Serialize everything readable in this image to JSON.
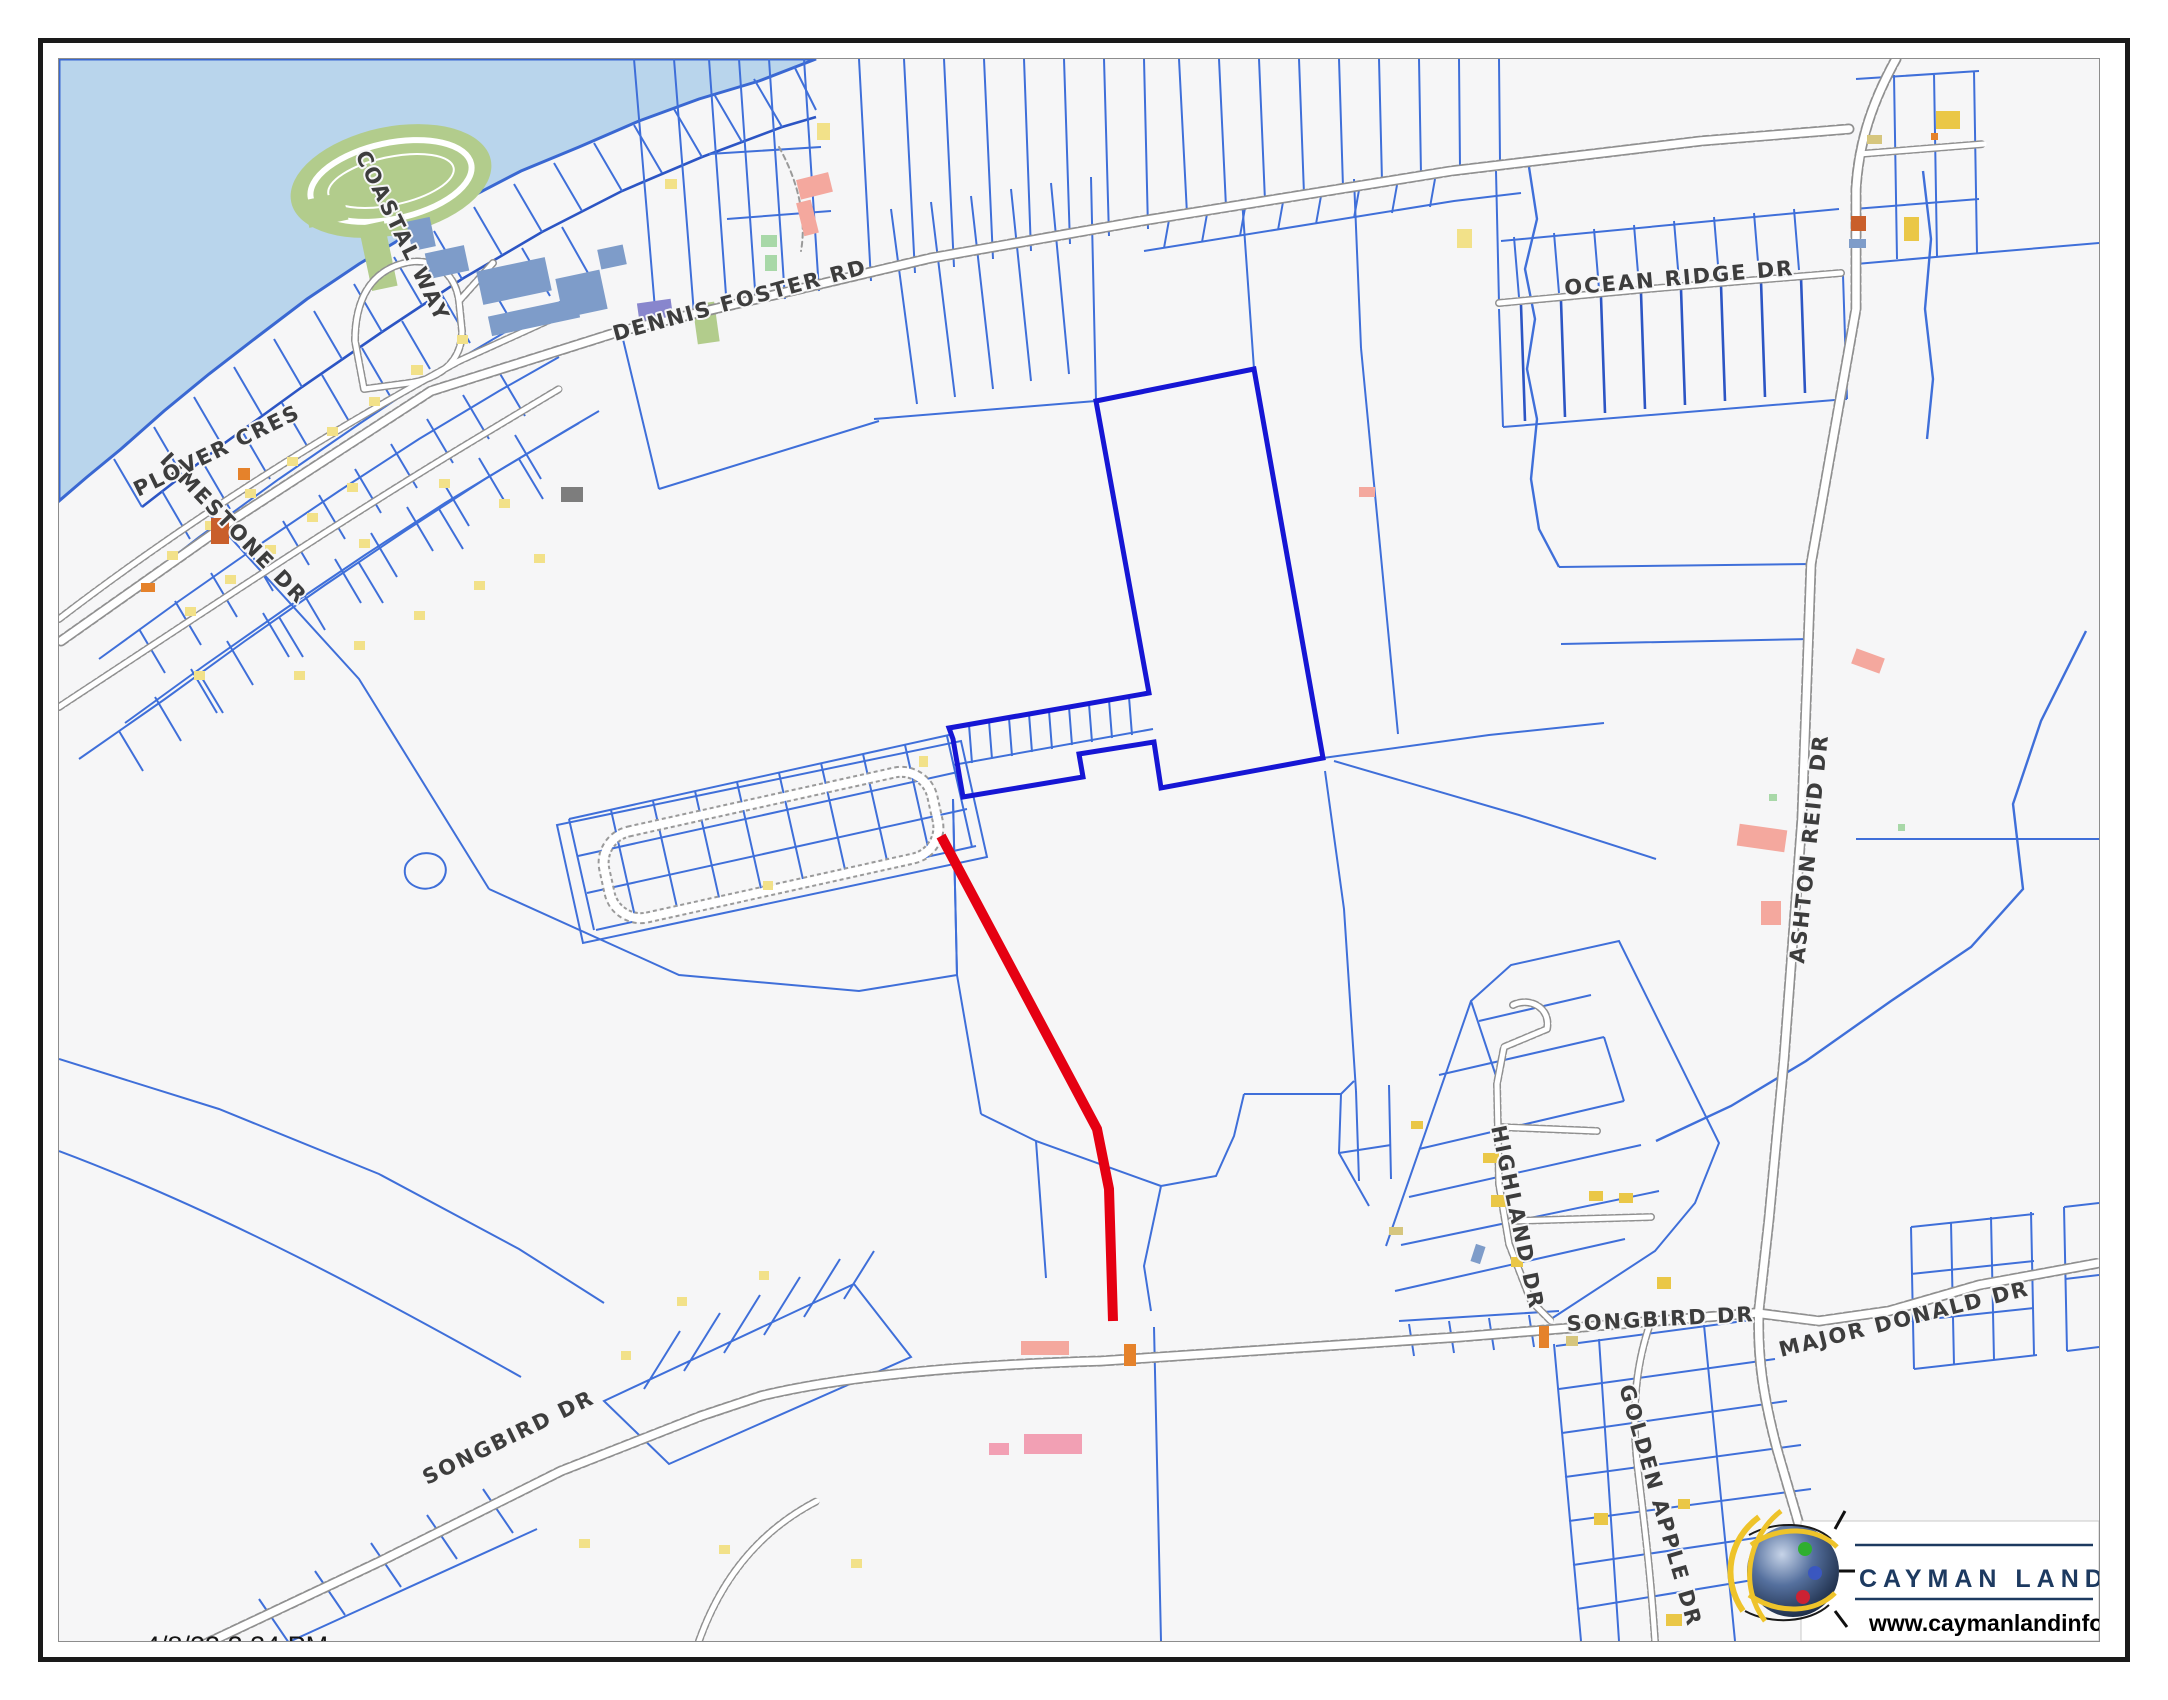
{
  "map": {
    "timestamp": "4/8/23 3:34 PM",
    "labels": {
      "limestone": "LIMESTONE DR",
      "plover": "PLOVER CRES",
      "coastal_way": "COASTAL WAY",
      "dennis_foster": "DENNIS FOSTER RD",
      "ocean_ridge": "OCEAN RIDGE DR",
      "ashton_reid": "ASHTON REID DR",
      "highland": "HIGHLAND DR",
      "songbird": "SONGBIRD DR",
      "major_donald": "MAJOR DONALD DR",
      "golden_apple": "GOLDEN APPLE DR"
    },
    "colors": {
      "water": "#b9d5ec",
      "parcel_line": "#3f6fd9",
      "selected_parcel": "#1616d4",
      "route_highlight": "#e50012"
    }
  },
  "branding": {
    "name": "CAYMAN LAND INFO",
    "website": "www.caymanlandinfo.ky"
  }
}
